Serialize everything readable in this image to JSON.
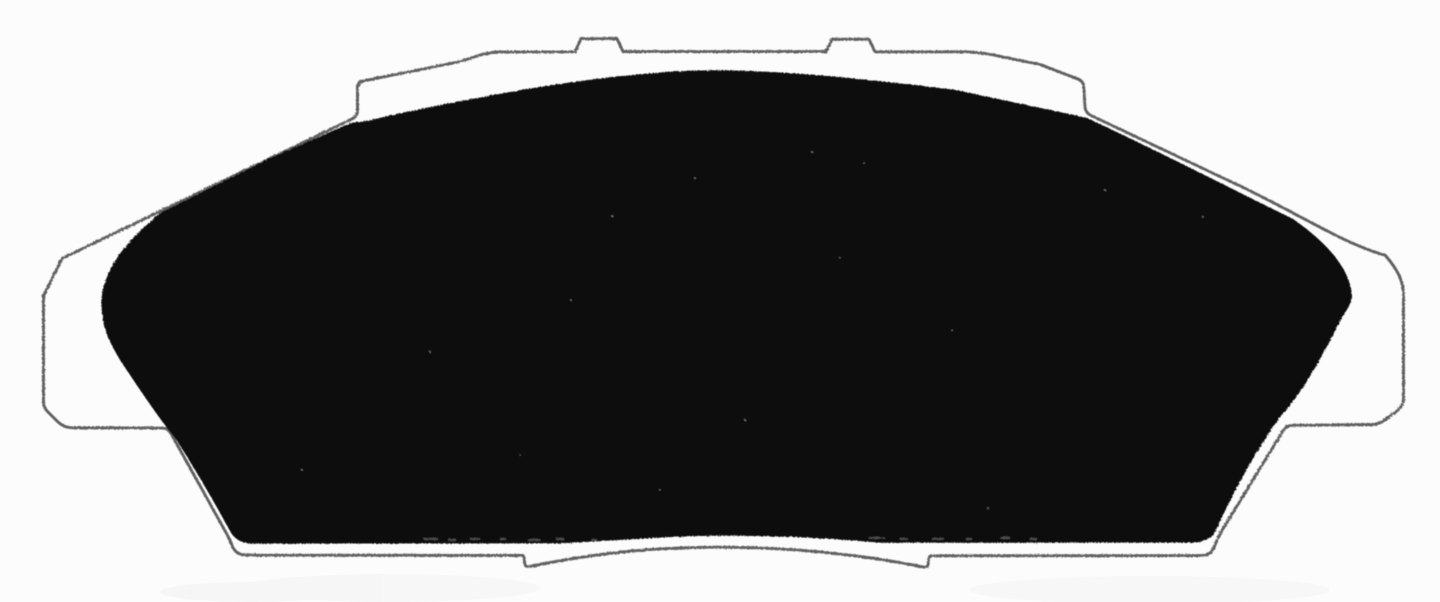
{
  "figure": {
    "title": "Brake pad silhouette",
    "description": "Black-and-white scanned diagram of a disc brake pad (front view): thin gray backing-plate outline with two top mounting tabs, side notches and a stepped lower edge, enclosing a solid black friction-material shape.",
    "outline_label": "Backing plate outline",
    "pad_label": "Friction material"
  },
  "canvas": {
    "width": "1440",
    "height": "602",
    "viewbox": "0 0 1440 602"
  },
  "colors": {
    "background": "#fcfcfc",
    "outline_stroke": "#545454",
    "pad_fill": "#070707",
    "speckle": "#d8d8d8",
    "dash_gray": "#8f8f8f",
    "wash_gray": "#9a9a9a"
  },
  "geometry": {
    "outline_path": "M 43.5 296 L 62 258.5 L 352 119 C 356 117 357.5 114 357.5 110 L 357.5 88 C 357.5 83.5 360 81.5 364 80.8 L 458 62 C 472 58.5 483 52.5 497 52 L 575 51.8 L 581 38.8 L 617 38.6 L 623 51.6 L 826 51.6 L 832 39.2 L 869 39.2 L 875 51.8 L 966 51.8 C 980 52.2 992 54.5 1003 57 L 1040 64.5 L 1078 79 C 1082 80.8 1083.5 83 1083.7 86 L 1085 107 C 1085.3 111 1087 113.5 1091 115.5 L 1240 186 C 1295 212 1348 246 1385 255 C 1398 270 1403.5 281 1403.5 296 L 1403.5 399 C 1403.5 404 1401 407.5 1397.5 410.5 L 1388 417.5 C 1382 422.5 1378 424.5 1370 424.5 L 1293 425.3 C 1288 425.4 1286 426.5 1283.5 430 L 1221 532 C 1218 537.5 1215.5 544 1213.5 548.5 C 1211.5 553.5 1206 555.6 1199 555.6 L 930 555.8 C 928.5 558 928.3 561 928.2 564 C 928.1 566 927 567.2 924.5 567.2 C 856 553.5 787 547.2 718 547.2 C 649 547.2 592 553.8 528.5 566.8 C 526 566.8 524.8 565.8 524.7 563.5 C 524.6 561 524.3 557.8 523 555.4 L 246.5 555.2 C 239 555.1 234.5 552 232 545.5 C 230.5 541.5 228.8 537.5 226.5 533.5 L 171.5 434.5 C 169.5 430.5 167 428.2 161.5 428.1 L 73 427.8 C 66 427.7 61.5 425.5 57.5 421.5 L 47 411 C 44.3 408.2 43.5 405.5 43.5 401.5 Z",
    "pad_path": "M 102 312 C 100 295 104 278 117 258 C 124 247 137 233 160 213 L 270 158 L 352 122.5 L 367 121 C 417 109 469 99.5 521 90 C 598 77.5 660 70.5 716 70.3 C 777 70.6 851 77 956 90 C 1000 99.5 1048 109.5 1087 118 C 1160 152 1230 188 1293 219 C 1323 240 1344 262 1350 285 C 1353 299 1352 303 1342 317 C 1315 372 1296 400 1283 413 C 1264 438 1239 481 1222 517 C 1216 532 1212 542 1193 542.6 L 882 542.8 C 803 536.2 760 535.6 716 535.8 C 671 536.2 628 539.8 558 543.4 L 253 543.6 C 240 543.4 233.5 538 229.5 530 C 206 487 190.5 462 176.5 440 C 158 417 140 390 120 360 C 108 339 104 330 102 312 Z",
    "speckles": [
      [
        695,
        178
      ],
      [
        812,
        152
      ],
      [
        864,
        163
      ],
      [
        612,
        216
      ],
      [
        571,
        300
      ],
      [
        745,
        420
      ],
      [
        952,
        330
      ],
      [
        1105,
        190
      ],
      [
        430,
        352
      ],
      [
        302,
        470
      ],
      [
        988,
        508
      ],
      [
        520,
        455
      ],
      [
        1203,
        217
      ],
      [
        840,
        258
      ],
      [
        660,
        490
      ]
    ],
    "dashes": [
      [
        424,
        538,
        14
      ],
      [
        448,
        539,
        8
      ],
      [
        470,
        538,
        10
      ],
      [
        500,
        538,
        6
      ],
      [
        528,
        539,
        12
      ],
      [
        556,
        538,
        8
      ],
      [
        591,
        539,
        6
      ],
      [
        869,
        537,
        16
      ],
      [
        900,
        538,
        8
      ],
      [
        932,
        538,
        12
      ],
      [
        966,
        538,
        6
      ],
      [
        1000,
        537,
        10
      ],
      [
        1030,
        538,
        7
      ]
    ],
    "washes": [
      [
        390,
        588,
        150,
        14
      ],
      [
        1150,
        590,
        180,
        14
      ],
      [
        250,
        592,
        90,
        10
      ]
    ]
  }
}
